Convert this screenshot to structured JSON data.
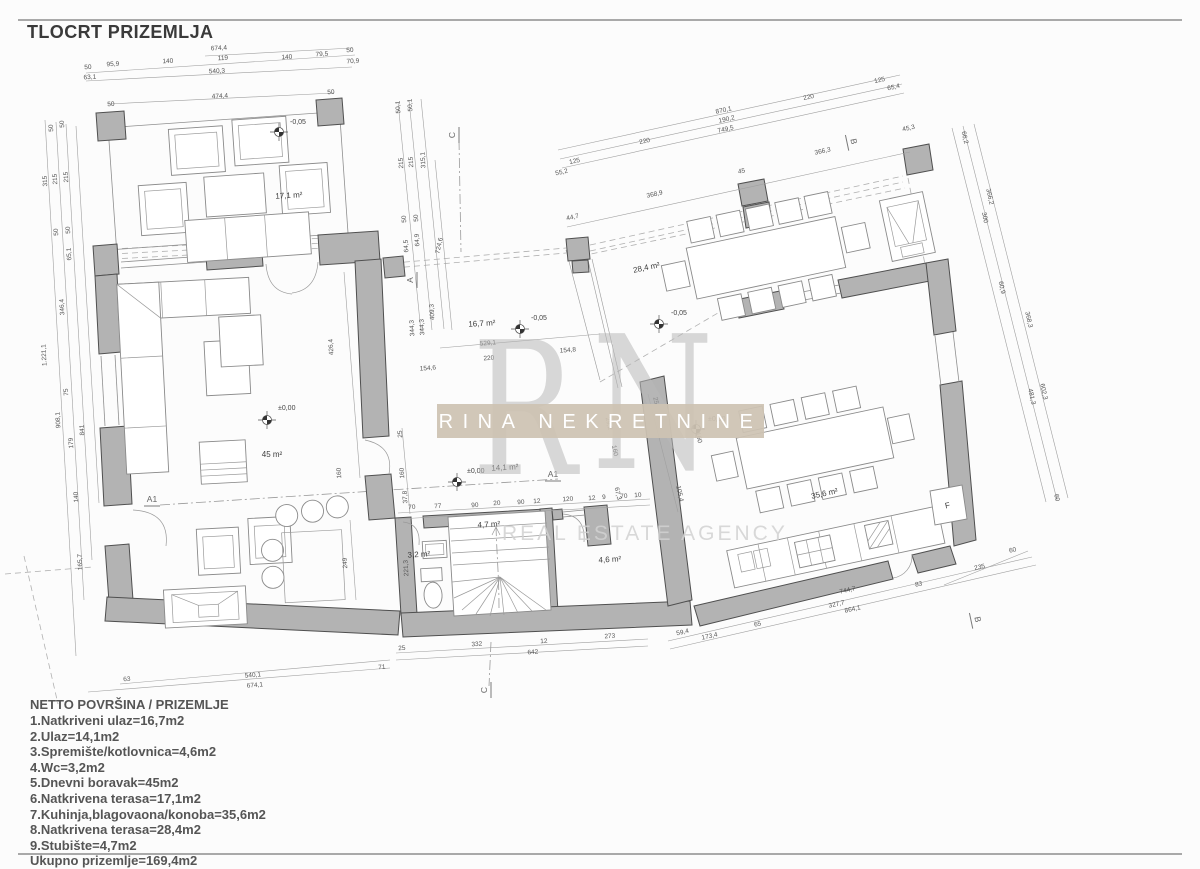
{
  "title": "TLOCRT PRIZEMLJA",
  "legend": {
    "title": "NETTO POVRŠINA / PRIZEMLJE",
    "items": [
      "1.Natkriveni ulaz=16,7m2",
      "2.Ulaz=14,1m2",
      "3.Spremište/kotlovnica=4,6m2",
      "4.Wc=3,2m2",
      "5.Dnevni boravak=45m2",
      "6.Natkrivena terasa=17,1m2",
      "7.Kuhinja,blagovaona/konoba=35,6m2",
      "8.Natkrivena terasa=28,4m2",
      "9.Stubište=4,7m2",
      "Ukupno prizemlje=169,4m2"
    ]
  },
  "watermark": {
    "letter_left": "R",
    "letter_right": "N",
    "band_text": "RINA NEKRETNINE",
    "sub_text": "REAL ESTATE AGENCY",
    "band_color": "#cec3b3"
  },
  "colors": {
    "wall_fill": "#b3b3b3",
    "paper": "#fcfcfc",
    "watermark_band": "#cec3b3",
    "watermark_text": "#ffffff"
  },
  "room_labels": [
    {
      "t": "17,1 m²",
      "x": 289,
      "y": 198,
      "r": -3
    },
    {
      "t": "45 m²",
      "x": 272,
      "y": 457,
      "r": 0
    },
    {
      "t": "16,7 m²",
      "x": 482,
      "y": 326,
      "r": -3
    },
    {
      "t": "14,1 m²",
      "x": 505,
      "y": 470,
      "r": -3
    },
    {
      "t": "28,4 m²",
      "x": 647,
      "y": 270,
      "r": -12
    },
    {
      "t": "35,6 m²",
      "x": 825,
      "y": 496,
      "r": -12
    },
    {
      "t": "4,7 m²",
      "x": 489,
      "y": 527,
      "r": -3
    },
    {
      "t": "3,2 m²",
      "x": 419,
      "y": 557,
      "r": -3
    },
    {
      "t": "4,6 m²",
      "x": 610,
      "y": 562,
      "r": -3
    },
    {
      "t": "F",
      "x": 948,
      "y": 508,
      "r": -12
    }
  ],
  "level_markers": [
    {
      "t": "-0,05",
      "x": 290,
      "y": 124,
      "sx": 279,
      "sy": 132
    },
    {
      "t": "±0,00",
      "x": 278,
      "y": 410,
      "sx": 267,
      "sy": 420
    },
    {
      "t": "-0,05",
      "x": 531,
      "y": 320,
      "sx": 520,
      "sy": 329
    },
    {
      "t": "±0,00",
      "x": 467,
      "y": 473,
      "sx": 457,
      "sy": 482
    },
    {
      "t": "-0,05",
      "x": 671,
      "y": 315,
      "sx": 659,
      "sy": 324
    },
    {
      "t": "±0,00",
      "x": 708,
      "y": 421,
      "sx": 696,
      "sy": 429
    }
  ],
  "section_markers": [
    {
      "t": "C",
      "x": 455,
      "y": 135,
      "r": -90
    },
    {
      "t": "A",
      "x": 413,
      "y": 280,
      "r": -90
    },
    {
      "t": "A1",
      "x": 152,
      "y": 502,
      "r": 0
    },
    {
      "t": "A1",
      "x": 553,
      "y": 477,
      "r": 0
    },
    {
      "t": "B",
      "x": 851,
      "y": 142,
      "r": 78
    },
    {
      "t": "B",
      "x": 975,
      "y": 620,
      "r": 78
    },
    {
      "t": "C",
      "x": 487,
      "y": 690,
      "r": -90
    }
  ],
  "dim_labels": [
    {
      "t": "674,4",
      "x": 219,
      "y": 50,
      "r": -3
    },
    {
      "t": "50",
      "x": 350,
      "y": 52,
      "r": -3
    },
    {
      "t": "79,5",
      "x": 322,
      "y": 56,
      "r": -3
    },
    {
      "t": "140",
      "x": 287,
      "y": 59,
      "r": -3
    },
    {
      "t": "119",
      "x": 223,
      "y": 60,
      "r": -3
    },
    {
      "t": "140",
      "x": 168,
      "y": 63,
      "r": -3
    },
    {
      "t": "95,9",
      "x": 113,
      "y": 66,
      "r": -3
    },
    {
      "t": "50",
      "x": 88,
      "y": 69,
      "r": -3
    },
    {
      "t": "70,9",
      "x": 353,
      "y": 63,
      "r": -3
    },
    {
      "t": "540,3",
      "x": 217,
      "y": 73,
      "r": -3
    },
    {
      "t": "63,1",
      "x": 90,
      "y": 79,
      "r": -3
    },
    {
      "t": "474,4",
      "x": 220,
      "y": 98,
      "r": -3
    },
    {
      "t": "50",
      "x": 331,
      "y": 94,
      "r": -3
    },
    {
      "t": "50",
      "x": 111,
      "y": 106,
      "r": -3
    },
    {
      "t": "50",
      "x": 64,
      "y": 124,
      "r": -93
    },
    {
      "t": "50",
      "x": 53,
      "y": 128,
      "r": -93
    },
    {
      "t": "215",
      "x": 68,
      "y": 177,
      "r": -93
    },
    {
      "t": "215",
      "x": 57,
      "y": 179,
      "r": -93
    },
    {
      "t": "315",
      "x": 47,
      "y": 181,
      "r": -93
    },
    {
      "t": "50",
      "x": 70,
      "y": 230,
      "r": -93
    },
    {
      "t": "50",
      "x": 58,
      "y": 232,
      "r": -93
    },
    {
      "t": "65,1",
      "x": 71,
      "y": 254,
      "r": -93
    },
    {
      "t": "346,4",
      "x": 64,
      "y": 307,
      "r": -93
    },
    {
      "t": "75",
      "x": 68,
      "y": 392,
      "r": -93
    },
    {
      "t": "908,1",
      "x": 60,
      "y": 420,
      "r": -93
    },
    {
      "t": "841",
      "x": 84,
      "y": 430,
      "r": -93
    },
    {
      "t": "179",
      "x": 73,
      "y": 443,
      "r": -93
    },
    {
      "t": "140",
      "x": 78,
      "y": 497,
      "r": -93
    },
    {
      "t": "165,7",
      "x": 82,
      "y": 562,
      "r": -93
    },
    {
      "t": "1.221,1",
      "x": 46,
      "y": 355,
      "r": -93
    },
    {
      "t": "50,1",
      "x": 400,
      "y": 107,
      "r": -93
    },
    {
      "t": "50,1",
      "x": 412,
      "y": 105,
      "r": -93
    },
    {
      "t": "215",
      "x": 403,
      "y": 163,
      "r": -93
    },
    {
      "t": "215",
      "x": 413,
      "y": 162,
      "r": -93
    },
    {
      "t": "315,1",
      "x": 425,
      "y": 160,
      "r": -93
    },
    {
      "t": "50",
      "x": 406,
      "y": 219,
      "r": -93
    },
    {
      "t": "50",
      "x": 418,
      "y": 218,
      "r": -93
    },
    {
      "t": "64,5",
      "x": 408,
      "y": 246,
      "r": -93
    },
    {
      "t": "64,9",
      "x": 419,
      "y": 240,
      "r": -93
    },
    {
      "t": "724,6",
      "x": 441,
      "y": 246,
      "r": -78
    },
    {
      "t": "409,3",
      "x": 434,
      "y": 312,
      "r": -93
    },
    {
      "t": "344,3",
      "x": 414,
      "y": 328,
      "r": -93
    },
    {
      "t": "344,3",
      "x": 424,
      "y": 327,
      "r": -93
    },
    {
      "t": "870,1",
      "x": 724,
      "y": 112,
      "r": -12
    },
    {
      "t": "190,2",
      "x": 727,
      "y": 121,
      "r": -12
    },
    {
      "t": "749,5",
      "x": 726,
      "y": 131,
      "r": -12
    },
    {
      "t": "220",
      "x": 809,
      "y": 99,
      "r": -12
    },
    {
      "t": "125",
      "x": 880,
      "y": 82,
      "r": -12
    },
    {
      "t": "65,4",
      "x": 894,
      "y": 89,
      "r": -12
    },
    {
      "t": "220",
      "x": 645,
      "y": 143,
      "r": -12
    },
    {
      "t": "125",
      "x": 575,
      "y": 163,
      "r": -12
    },
    {
      "t": "55,2",
      "x": 562,
      "y": 174,
      "r": -12
    },
    {
      "t": "366,3",
      "x": 823,
      "y": 153,
      "r": -12
    },
    {
      "t": "45,3",
      "x": 909,
      "y": 130,
      "r": -12
    },
    {
      "t": "368,9",
      "x": 655,
      "y": 196,
      "r": -12
    },
    {
      "t": "44,7",
      "x": 573,
      "y": 219,
      "r": -12
    },
    {
      "t": "45",
      "x": 742,
      "y": 173,
      "r": -12
    },
    {
      "t": "66,2",
      "x": 963,
      "y": 138,
      "r": 78
    },
    {
      "t": "366,2",
      "x": 988,
      "y": 197,
      "r": 78
    },
    {
      "t": "300",
      "x": 983,
      "y": 218,
      "r": 78
    },
    {
      "t": "60,9",
      "x": 1000,
      "y": 288,
      "r": 78
    },
    {
      "t": "368,3",
      "x": 1027,
      "y": 320,
      "r": 78
    },
    {
      "t": "602,3",
      "x": 1042,
      "y": 392,
      "r": 78
    },
    {
      "t": "481,3",
      "x": 1030,
      "y": 397,
      "r": 78
    },
    {
      "t": "60",
      "x": 1055,
      "y": 498,
      "r": 78
    },
    {
      "t": "235",
      "x": 980,
      "y": 569,
      "r": -12
    },
    {
      "t": "60",
      "x": 1013,
      "y": 552,
      "r": -12
    },
    {
      "t": "63",
      "x": 127,
      "y": 681,
      "r": -4
    },
    {
      "t": "540,1",
      "x": 253,
      "y": 677,
      "r": -4
    },
    {
      "t": "674,1",
      "x": 255,
      "y": 687,
      "r": -4
    },
    {
      "t": "71",
      "x": 382,
      "y": 669,
      "r": -4
    },
    {
      "t": "25",
      "x": 402,
      "y": 650,
      "r": -4
    },
    {
      "t": "332",
      "x": 477,
      "y": 646,
      "r": -4
    },
    {
      "t": "12",
      "x": 544,
      "y": 643,
      "r": -4
    },
    {
      "t": "273",
      "x": 610,
      "y": 638,
      "r": -4
    },
    {
      "t": "642",
      "x": 533,
      "y": 654,
      "r": -4
    },
    {
      "t": "59,4",
      "x": 683,
      "y": 634,
      "r": -12
    },
    {
      "t": "173,4",
      "x": 710,
      "y": 638,
      "r": -12
    },
    {
      "t": "65",
      "x": 758,
      "y": 626,
      "r": -12
    },
    {
      "t": "744,7",
      "x": 848,
      "y": 592,
      "r": -12
    },
    {
      "t": "83",
      "x": 919,
      "y": 586,
      "r": -12
    },
    {
      "t": "327,7",
      "x": 837,
      "y": 606,
      "r": -12
    },
    {
      "t": "864,1",
      "x": 853,
      "y": 611,
      "r": -12
    },
    {
      "t": "25",
      "x": 402,
      "y": 434,
      "r": -93
    },
    {
      "t": "160",
      "x": 404,
      "y": 473,
      "r": -93
    },
    {
      "t": "37,8",
      "x": 407,
      "y": 497,
      "r": -93
    },
    {
      "t": "221,3",
      "x": 408,
      "y": 568,
      "r": -93
    },
    {
      "t": "70",
      "x": 412,
      "y": 509,
      "r": -4
    },
    {
      "t": "77",
      "x": 438,
      "y": 508,
      "r": -4
    },
    {
      "t": "90",
      "x": 475,
      "y": 507,
      "r": -4
    },
    {
      "t": "20",
      "x": 497,
      "y": 505,
      "r": -4
    },
    {
      "t": "90",
      "x": 521,
      "y": 504,
      "r": -4
    },
    {
      "t": "12",
      "x": 537,
      "y": 503,
      "r": -4
    },
    {
      "t": "120",
      "x": 568,
      "y": 501,
      "r": -4
    },
    {
      "t": "12",
      "x": 592,
      "y": 500,
      "r": -4
    },
    {
      "t": "9",
      "x": 604,
      "y": 499,
      "r": -4
    },
    {
      "t": "70",
      "x": 624,
      "y": 498,
      "r": -4
    },
    {
      "t": "10",
      "x": 638,
      "y": 497,
      "r": -4
    },
    {
      "t": "29,2",
      "x": 607,
      "y": 424,
      "r": 78
    },
    {
      "t": "160",
      "x": 613,
      "y": 451,
      "r": 78
    },
    {
      "t": "67,3",
      "x": 616,
      "y": 494,
      "r": 78
    },
    {
      "t": "25",
      "x": 654,
      "y": 401,
      "r": 78
    },
    {
      "t": "160",
      "x": 697,
      "y": 438,
      "r": 78
    },
    {
      "t": "105,4",
      "x": 678,
      "y": 494,
      "r": 78
    },
    {
      "t": "426,4",
      "x": 333,
      "y": 347,
      "r": -93
    },
    {
      "t": "160",
      "x": 341,
      "y": 473,
      "r": -93
    },
    {
      "t": "249",
      "x": 347,
      "y": 563,
      "r": -93
    },
    {
      "t": "529,1",
      "x": 488,
      "y": 345,
      "r": -4
    },
    {
      "t": "220",
      "x": 489,
      "y": 360,
      "r": -4
    },
    {
      "t": "154,8",
      "x": 568,
      "y": 352,
      "r": -4
    },
    {
      "t": "154,6",
      "x": 428,
      "y": 370,
      "r": -4
    }
  ]
}
